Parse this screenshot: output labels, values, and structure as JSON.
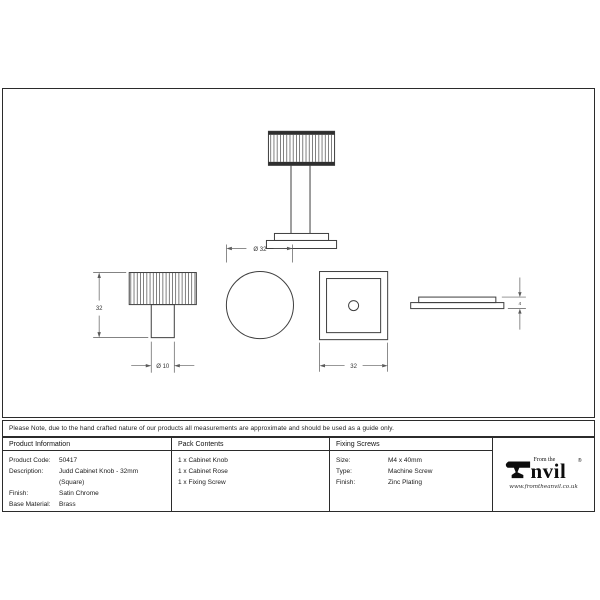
{
  "note": "Please Note, due to the hand crafted nature of our products all measurements are approximate and should be used as a guide only.",
  "drawing": {
    "dimensions": {
      "knob_height": "32",
      "stem_diameter": "Ø 10",
      "knob_diameter": "Ø 32",
      "rose_width": "32",
      "rose_thickness": "4"
    }
  },
  "table": {
    "product_information": {
      "header": "Product Information",
      "rows": [
        {
          "label": "Product Code:",
          "value": "50417"
        },
        {
          "label": "Description:",
          "value": "Judd Cabinet Knob - 32mm"
        },
        {
          "label": "",
          "value": "(Square)"
        },
        {
          "label": "Finish:",
          "value": "Satin Chrome"
        },
        {
          "label": "Base Material:",
          "value": "Brass"
        }
      ]
    },
    "pack_contents": {
      "header": "Pack Contents",
      "items": [
        "1 x Cabinet Knob",
        "1 x Cabinet Rose",
        "1 x Fixing Screw"
      ]
    },
    "fixing_screws": {
      "header": "Fixing Screws",
      "rows": [
        {
          "label": "Size:",
          "value": "M4 x 40mm"
        },
        {
          "label": "Type:",
          "value": "Machine Screw"
        },
        {
          "label": "Finish:",
          "value": "Zinc Plating"
        }
      ]
    }
  },
  "logo": {
    "tagline": "From the",
    "wordmark_suffix": "nvil",
    "registered": "®",
    "url": "www.fromtheanvil.co.uk"
  },
  "colors": {
    "line": "#3f3f3f",
    "dark_band": "#2f2f2f",
    "border": "#2b2b2b"
  }
}
